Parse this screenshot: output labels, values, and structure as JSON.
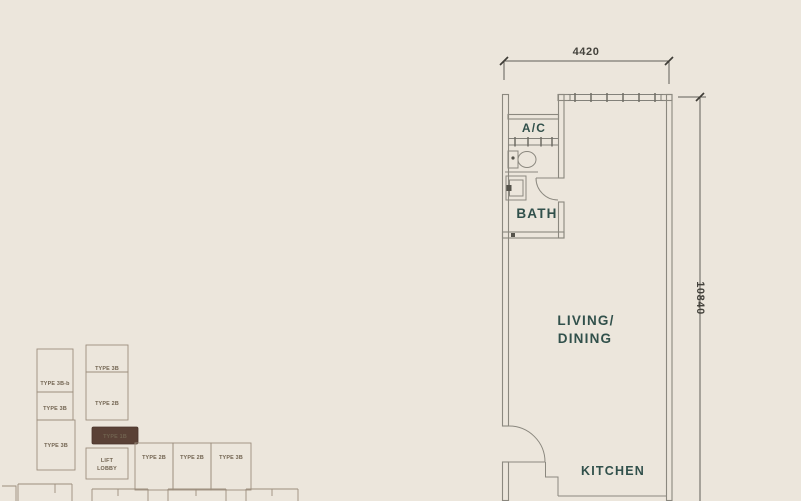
{
  "floor_plan": {
    "room_labels": {
      "ac": "A/C",
      "bath": "BATH",
      "living_line1": "LIVING/",
      "living_line2": "DINING",
      "kitchen": "KITCHEN"
    },
    "dimensions": {
      "top_width_mm": "4420",
      "right_height_mm": "10840"
    }
  },
  "key_plan": {
    "units": [
      {
        "label": "TYPE 3B-b"
      },
      {
        "label": "TYPE 3B"
      },
      {
        "label": "TYPE 3B"
      },
      {
        "label": "TYPE 3B"
      },
      {
        "label": "TYPE 2B"
      },
      {
        "label": "TYPE 2B"
      },
      {
        "label": "TYPE 2B"
      },
      {
        "label": "TYPE 3B"
      }
    ],
    "highlighted_unit": {
      "label": "TYPE 1B"
    },
    "lift_lobby": {
      "line1": "LIFT",
      "line2": "LOBBY"
    }
  },
  "colors": {
    "background": "#ece6dc",
    "wall_line": "#8b887f",
    "room_label": "#31504b",
    "dimension_text": "#44423c",
    "keyplan_line": "#9c8e7d",
    "keyplan_label": "#70624f",
    "highlight_fill": "#5a4136",
    "highlight_text": "#ead8bf"
  }
}
